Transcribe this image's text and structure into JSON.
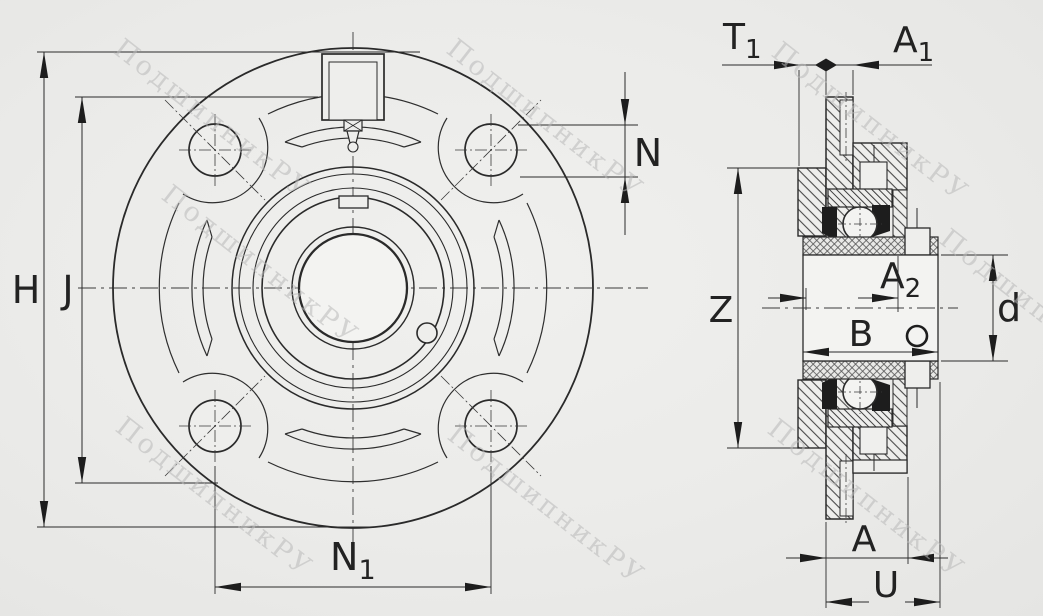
{
  "front_view": {
    "dim_height": "H",
    "dim_bolt_circle": "J",
    "dim_hole": "N",
    "dim_hole_spacing": {
      "base": "N",
      "sub": "1"
    }
  },
  "side_view": {
    "dim_t1": {
      "base": "T",
      "sub": "1"
    },
    "dim_a1": {
      "base": "A",
      "sub": "1"
    },
    "dim_a2": {
      "base": "A",
      "sub": "2"
    },
    "dim_z": "Z",
    "dim_b": "B",
    "dim_d": "d",
    "dim_a": "A",
    "dim_u": "U"
  },
  "watermark": {
    "text": "ПодшипникРУ",
    "color": "#b9b9b9"
  },
  "colors": {
    "line": "#2a2a2a",
    "background": "#ecedeb",
    "hatch": "#4a4a4a"
  }
}
